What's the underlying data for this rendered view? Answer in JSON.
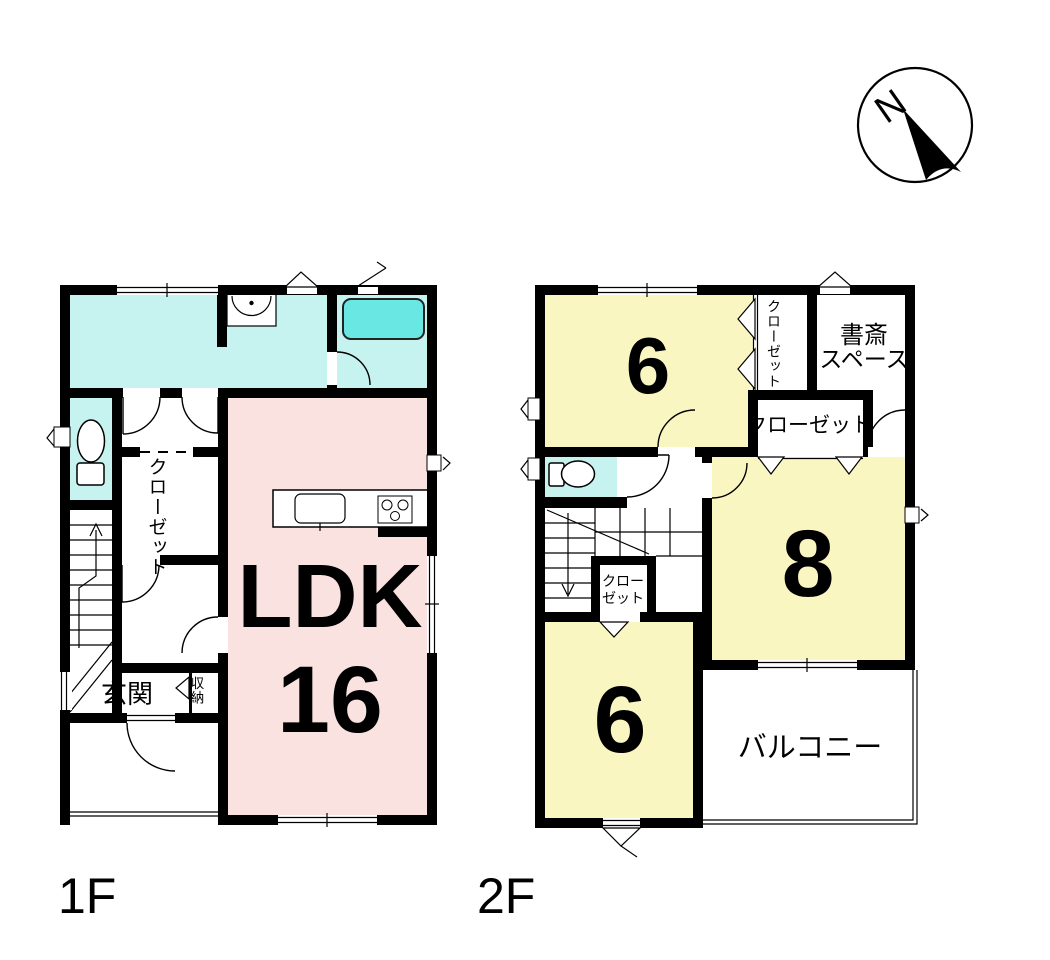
{
  "compass": {
    "north": "N"
  },
  "floor1": {
    "label": "1F",
    "ldk_label": "LDK",
    "ldk_size": "16",
    "entrance": "玄関",
    "storage": "収納",
    "closet": "クローゼット"
  },
  "floor2": {
    "label": "2F",
    "room6_top": "6",
    "room8": "8",
    "room6_bottom": "6",
    "study_line1": "書斎",
    "study_line2": "スペース",
    "closet_vertical": "クローゼット",
    "closet_horizontal": "クローゼット",
    "closet_small_line1": "クロー",
    "closet_small_line2": "ゼット",
    "balcony": "バルコニー"
  },
  "colors": {
    "wall": "#000000",
    "water_room": "#c6f2f0",
    "bathtub": "#68e7e3",
    "ldk_pink": "#f9e2e0",
    "room_yellow": "#faf6c2",
    "background": "#ffffff"
  }
}
